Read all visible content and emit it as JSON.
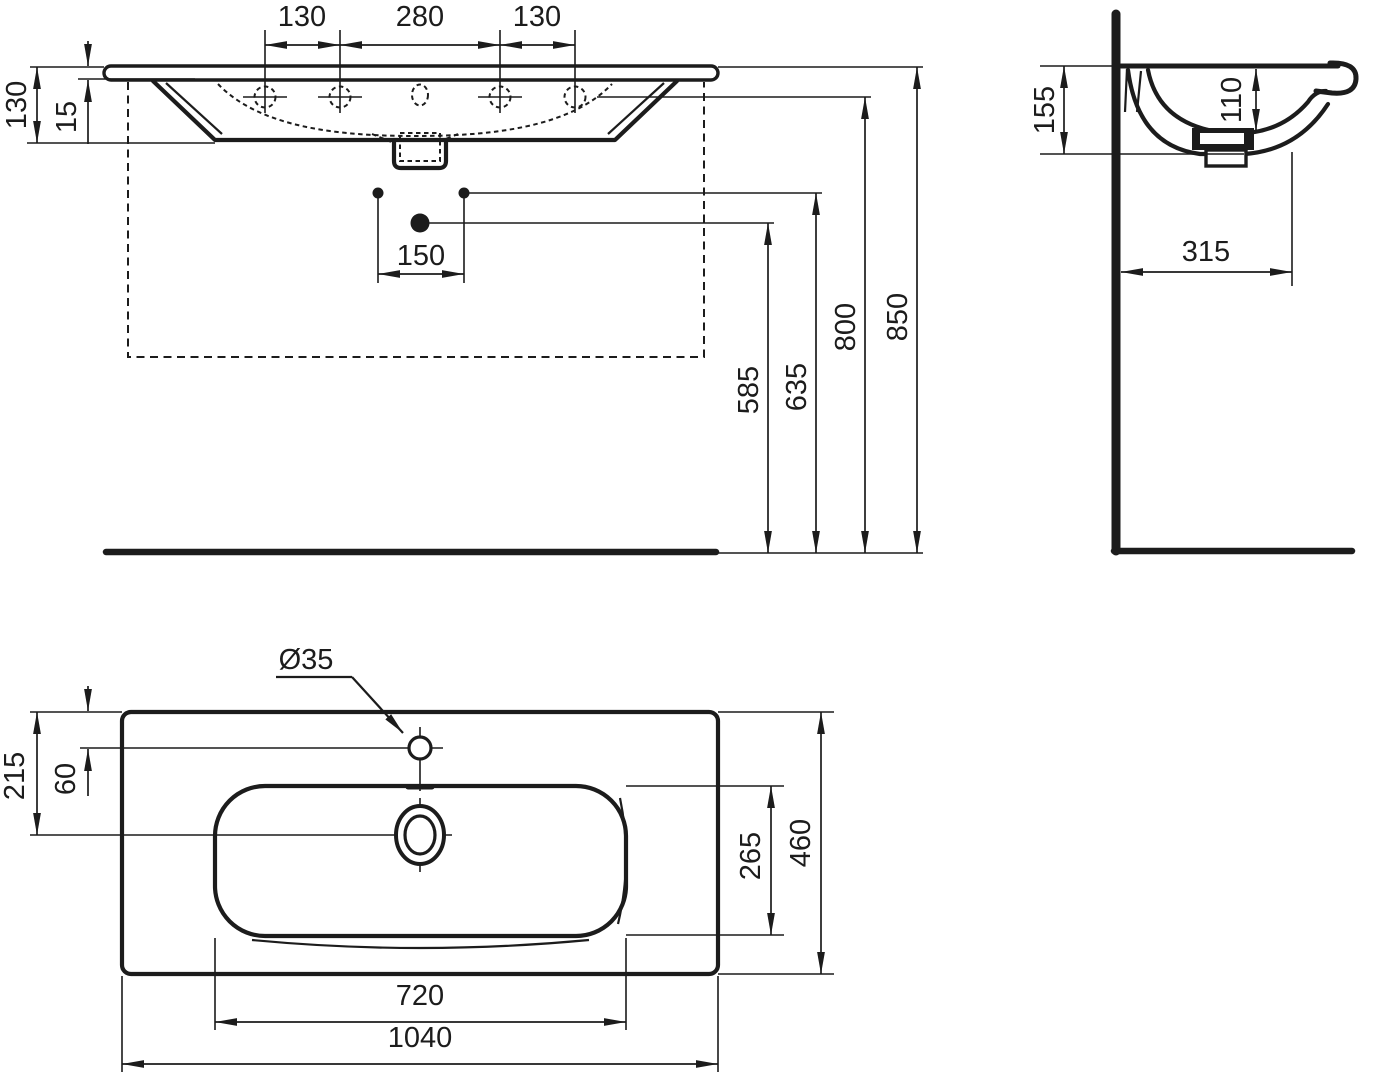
{
  "colors": {
    "background": "#ffffff",
    "line": "#1c1c1c"
  },
  "front_view": {
    "tap_spacing_left": "130",
    "tap_spacing_center": "280",
    "tap_spacing_right": "130",
    "ceramic_height": "130",
    "rim_thickness": "15",
    "fixing_spacing": "150",
    "height_trap": "585",
    "height_fixing": "635",
    "height_tap_deck": "800",
    "height_rim": "850"
  },
  "side_view": {
    "back_height": "155",
    "bowl_depth": "110",
    "wall_distance": "315"
  },
  "plan_view": {
    "tap_hole_diameter": "Ø35",
    "tap_hole_offset": "60",
    "drain_offset": "215",
    "bowl_inner_depth": "265",
    "overall_depth": "460",
    "bowl_inner_width": "720",
    "overall_width": "1040"
  }
}
